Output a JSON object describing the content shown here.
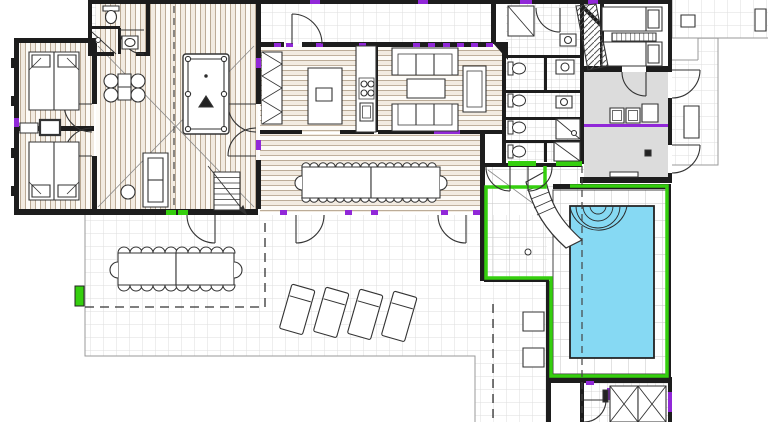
{
  "meta": {
    "title": "architectural-floor-plan",
    "view": "top-down-plan",
    "drawing_style": "cad-floor-plan"
  },
  "colors": {
    "background": "#ffffff",
    "wall": "#1d1d1d",
    "line": "#333333",
    "wood_line": "#a8927a",
    "tile_line": "#dddddd",
    "utility_gray": "#dcdcdc",
    "pool_water": "#86d9f3",
    "pool_frame_green": "#35cf0e",
    "accent_green": "#35cf0e",
    "accent_purple": "#9128d8",
    "boundary": "#999999",
    "furniture_fill": "#ffffff"
  },
  "legend": {
    "rooms": [
      "bedroom-upper-left",
      "bedroom-lower-left",
      "bathroom-top-left",
      "games-room",
      "patio-courtyard",
      "kitchen",
      "living-room",
      "dining-room",
      "bathroom-block",
      "bedroom-suite-right",
      "utility-room",
      "laundry-room",
      "pool-house",
      "swimming-pool",
      "terrace",
      "walkway-right",
      "storage-room-bottom-right"
    ],
    "furniture": [
      {
        "name": "double-bed",
        "count": 2
      },
      {
        "name": "single-bed",
        "count": 2
      },
      {
        "name": "billiard-table",
        "count": 1
      },
      {
        "name": "games-chair",
        "count": 4
      },
      {
        "name": "games-table",
        "count": 2
      },
      {
        "name": "sofa",
        "count": 3
      },
      {
        "name": "armchair",
        "count": 1
      },
      {
        "name": "coffee-table",
        "count": 1
      },
      {
        "name": "kitchen-island",
        "count": 1
      },
      {
        "name": "stove-burner",
        "count": 4
      },
      {
        "name": "pantry-shelf",
        "count": 1
      },
      {
        "name": "indoor-dining-table",
        "count": 2
      },
      {
        "name": "indoor-dining-chair",
        "count": 34
      },
      {
        "name": "outdoor-dining-table",
        "count": 2
      },
      {
        "name": "outdoor-dining-chair",
        "count": 22
      },
      {
        "name": "sun-lounger",
        "count": 4
      },
      {
        "name": "water-slide",
        "count": 1
      },
      {
        "name": "toilet",
        "count": 5
      },
      {
        "name": "shower",
        "count": 4
      },
      {
        "name": "sink",
        "count": 5
      },
      {
        "name": "washing-machine",
        "count": 2
      },
      {
        "name": "wardrobe-x-unit",
        "count": 2
      },
      {
        "name": "staircase",
        "count": 1
      },
      {
        "name": "side-table",
        "count": 2
      }
    ]
  }
}
